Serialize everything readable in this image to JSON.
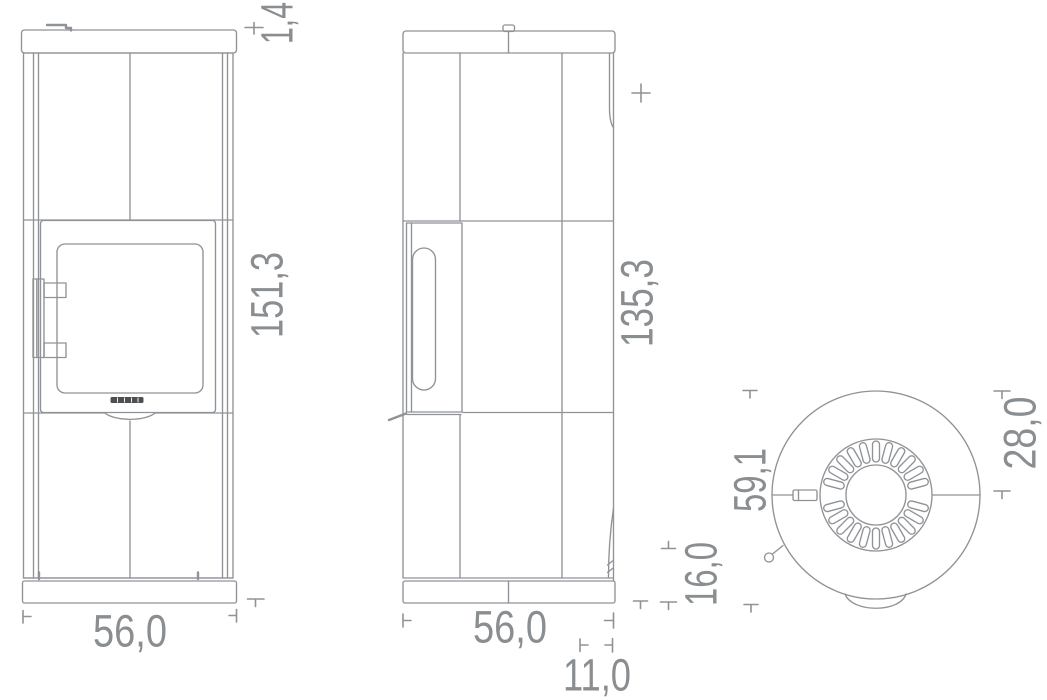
{
  "colors": {
    "background": "#ffffff",
    "line": "#8f9296",
    "dim_text": "#8a8e91",
    "logo": "#4c5053"
  },
  "dimensions": {
    "front_height": "151,3",
    "front_top": "1,4",
    "front_width": "56,0",
    "side_height": "135,3",
    "side_width": "56,0",
    "side_offset": "11,0",
    "side_lower": "16,0",
    "top_depth": "59,1",
    "top_rear": "28,0"
  }
}
